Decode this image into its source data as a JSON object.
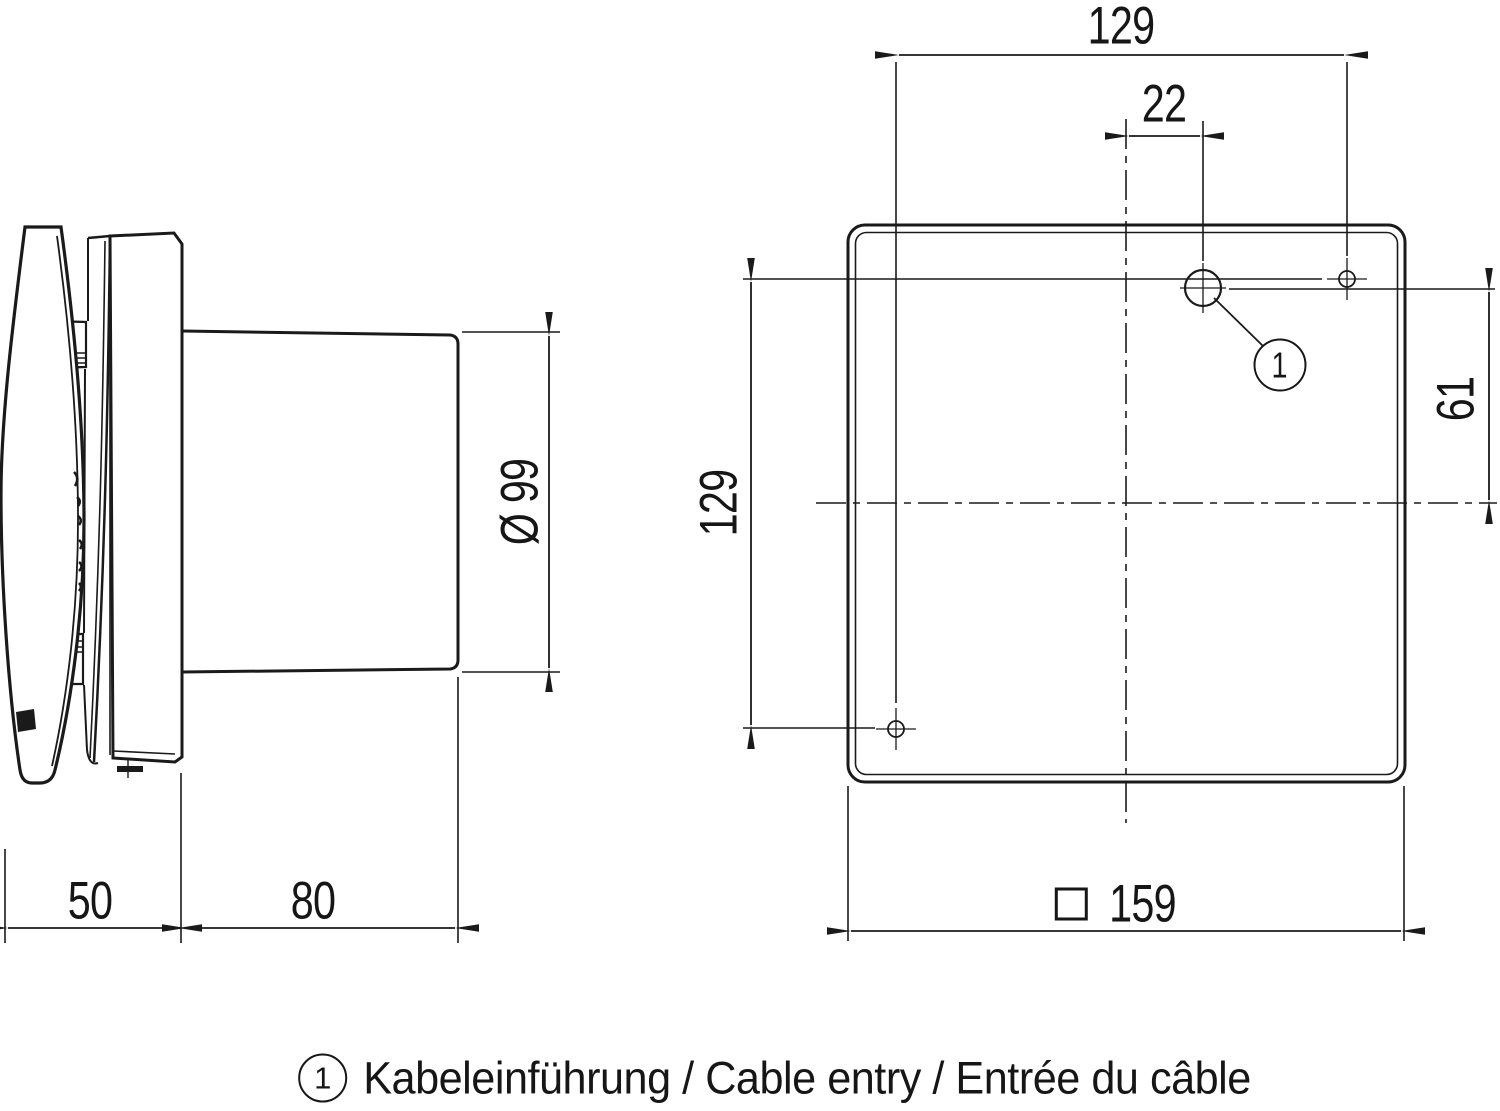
{
  "figure": {
    "side_view": {
      "front_depth": "50",
      "duct_length": "80",
      "duct_diameter": "Ø 99"
    },
    "front_view": {
      "hole_spacing_horizontal": "129",
      "hole_spacing_vertical": "129",
      "cable_entry_offset": "22",
      "cable_entry_height": "61",
      "panel_size": "159",
      "panel_size_symbol": "□",
      "cable_entry_marker": "1"
    },
    "caption": {
      "marker": "1",
      "text": "Kabeleinführung / Cable entry / Entrée du câble"
    }
  }
}
